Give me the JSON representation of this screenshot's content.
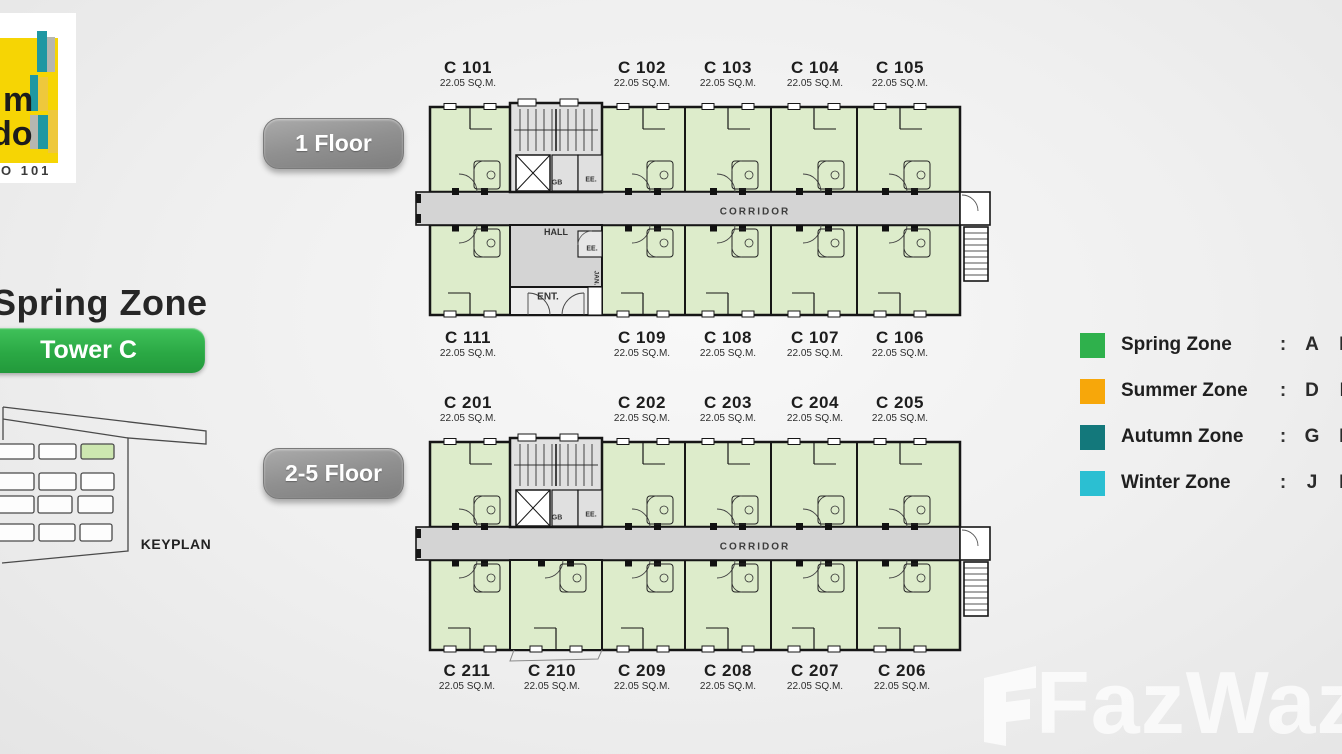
{
  "logo": {
    "fragment_top": "m",
    "fragment_bottom": "do",
    "caption": "O 101",
    "yellow": "#f6d504",
    "teal": "#1f97a2",
    "gray": "#b6b6b0"
  },
  "header": {
    "zone_title": "Spring Zone",
    "tower_label": "Tower C",
    "tower_color": "#2ba945"
  },
  "keyplan": {
    "caption": "KEYPLAN",
    "highlight_color": "#cde7b0"
  },
  "floor1": {
    "button_label": "1 Floor",
    "top_units": [
      {
        "name": "C 101",
        "area": "22.05 SQ.M."
      },
      {
        "name": "C 102",
        "area": "22.05 SQ.M."
      },
      {
        "name": "C 103",
        "area": "22.05 SQ.M."
      },
      {
        "name": "C 104",
        "area": "22.05 SQ.M."
      },
      {
        "name": "C 105",
        "area": "22.05 SQ.M."
      }
    ],
    "bottom_units": [
      {
        "name": "C 111",
        "area": "22.05 SQ.M."
      },
      {
        "name": "C 109",
        "area": "22.05 SQ.M."
      },
      {
        "name": "C 108",
        "area": "22.05 SQ.M."
      },
      {
        "name": "C 107",
        "area": "22.05 SQ.M."
      },
      {
        "name": "C 106",
        "area": "22.05 SQ.M."
      }
    ]
  },
  "floor2": {
    "button_label": "2-5 Floor",
    "top_units": [
      {
        "name": "C 201",
        "area": "22.05 SQ.M."
      },
      {
        "name": "C 202",
        "area": "22.05 SQ.M."
      },
      {
        "name": "C 203",
        "area": "22.05 SQ.M."
      },
      {
        "name": "C 204",
        "area": "22.05 SQ.M."
      },
      {
        "name": "C 205",
        "area": "22.05 SQ.M."
      }
    ],
    "bottom_units": [
      {
        "name": "C 211",
        "area": "22.05 SQ.M."
      },
      {
        "name": "C 210",
        "area": "22.05 SQ.M."
      },
      {
        "name": "C 209",
        "area": "22.05 SQ.M."
      },
      {
        "name": "C 208",
        "area": "22.05 SQ.M."
      },
      {
        "name": "C 207",
        "area": "22.05 SQ.M."
      },
      {
        "name": "C 206",
        "area": "22.05 SQ.M."
      }
    ]
  },
  "plan_labels": {
    "corridor": "CORRIDOR",
    "hall": "HALL",
    "entrance": "ENT.",
    "gb": "GB",
    "ee": "EE.",
    "jan": "JAN."
  },
  "legend": {
    "colon": ":",
    "items": [
      {
        "label": "Spring Zone",
        "color": "#2fb14c",
        "letters": [
          "A",
          "B"
        ]
      },
      {
        "label": "Summer Zone",
        "color": "#f7a70a",
        "letters": [
          "D",
          "E"
        ]
      },
      {
        "label": "Autumn Zone",
        "color": "#13787b",
        "letters": [
          "G",
          "H"
        ]
      },
      {
        "label": "Winter Zone",
        "color": "#2bbfd2",
        "letters": [
          "J",
          "K"
        ]
      }
    ]
  },
  "watermark": {
    "text": "FazWaz"
  }
}
